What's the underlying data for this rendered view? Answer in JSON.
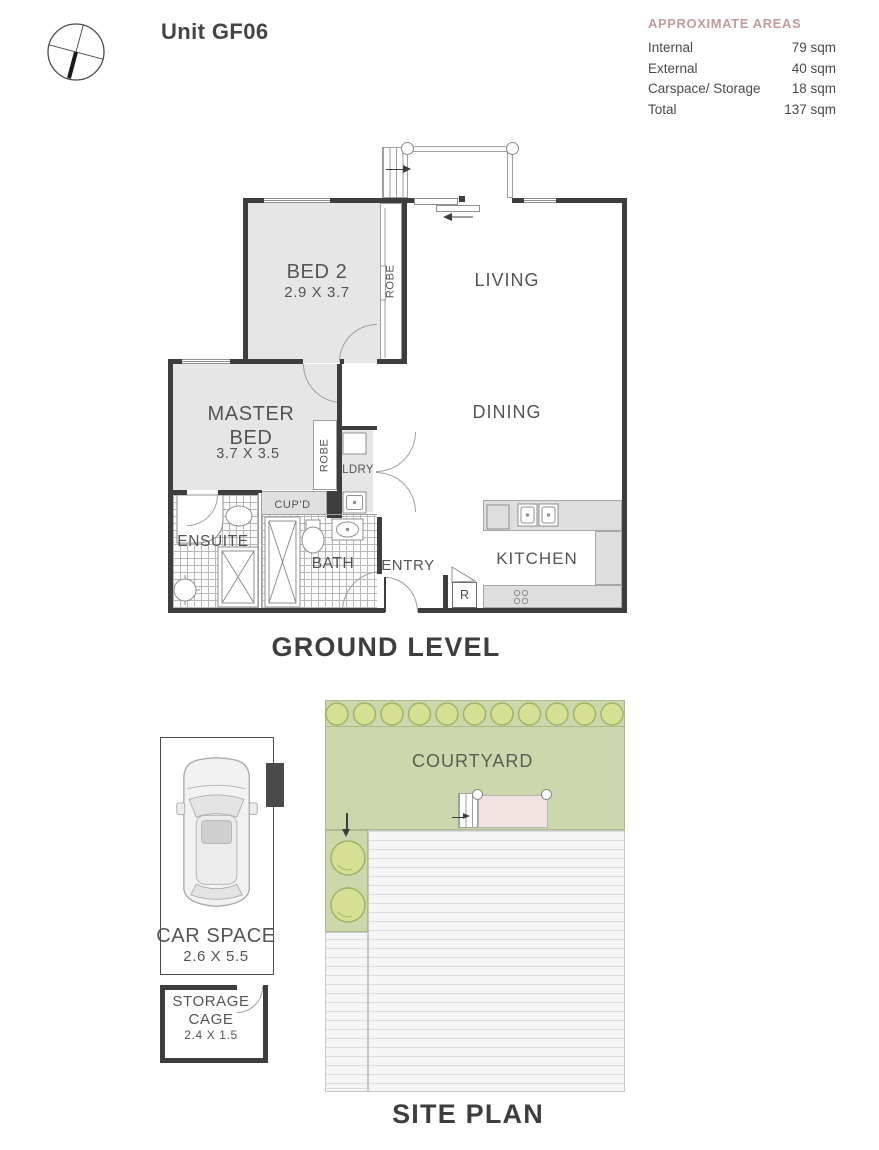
{
  "header": {
    "title": "Unit GF06",
    "areas": {
      "heading": "APPROXIMATE AREAS",
      "rows": [
        {
          "label": "Internal",
          "value": "79 sqm"
        },
        {
          "label": "External",
          "value": "40 sqm"
        },
        {
          "label": "Carspace/ Storage",
          "value": "18 sqm"
        },
        {
          "label": "Total",
          "value": "137 sqm"
        }
      ]
    }
  },
  "ground": {
    "title": "GROUND LEVEL",
    "labels": {
      "bed2": "BED 2",
      "bed2_dims": "2.9 X 3.7",
      "robe_bed2": "ROBE",
      "living": "LIVING",
      "master": "MASTER BED",
      "master_dims": "3.7 X 3.5",
      "robe_master": "ROBE",
      "dining": "DINING",
      "ldry": "LDRY",
      "cupd": "CUP'D",
      "ensuite": "ENSUITE",
      "bath": "BATH",
      "entry": "ENTRY",
      "kitchen": "KITCHEN",
      "fridge": "R"
    }
  },
  "site": {
    "title": "SITE PLAN",
    "labels": {
      "courtyard": "COURTYARD",
      "car_space": "CAR SPACE",
      "car_space_dims": "2.6 X 5.5",
      "storage": "STORAGE CAGE",
      "storage_dims": "2.4 X 1.5"
    }
  },
  "colors": {
    "wall": "#3e3e3e",
    "room_fill": "#e6e6e6",
    "counter_fill": "#dedede",
    "text": "#4f4f4f",
    "areas_heading": "#c49b9c",
    "courtyard_green": "#cdd7ad",
    "bush_green": "#d5e095",
    "bush_stroke": "#a0b464",
    "deck_pink": "#f2e3e2",
    "roof_stripe": "#dcdcdc"
  }
}
